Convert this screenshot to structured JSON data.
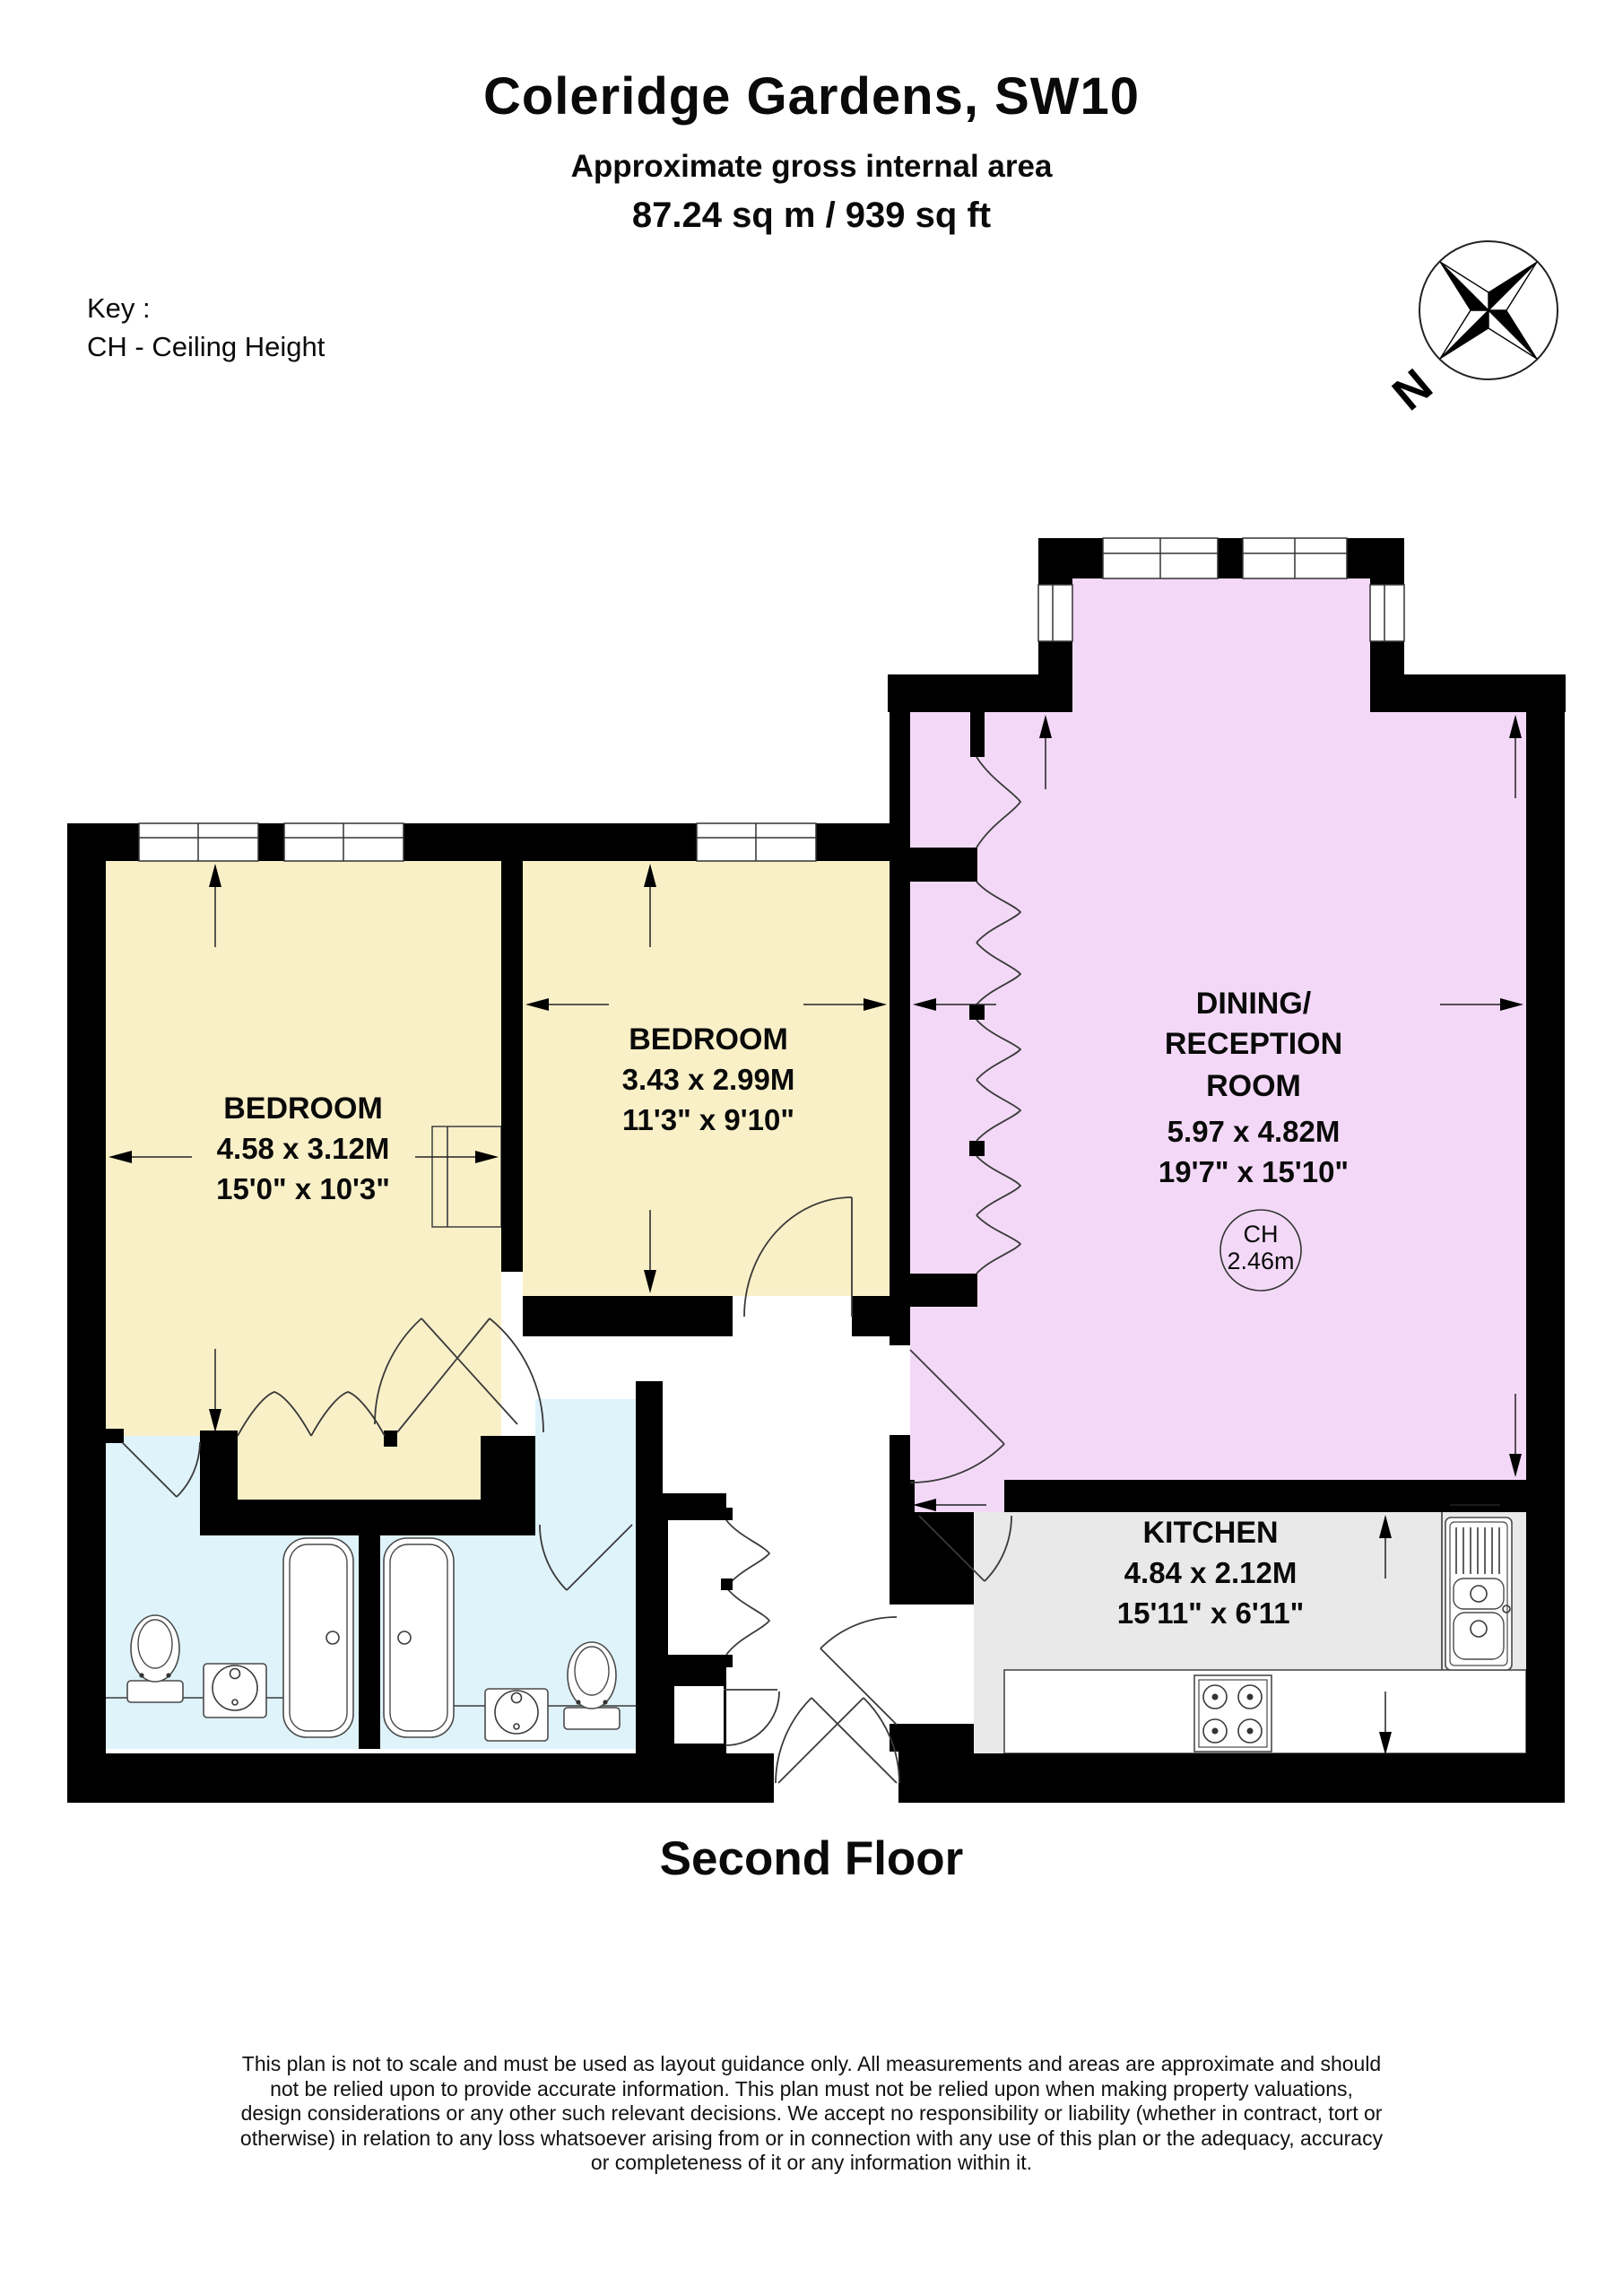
{
  "header": {
    "title": "Coleridge Gardens, SW10",
    "subtitle": "Approximate gross internal area",
    "area": "87.24 sq m /  939 sq ft"
  },
  "key": {
    "heading": "Key :",
    "line": "CH - Ceiling Height"
  },
  "compass": {
    "label": "N"
  },
  "rooms": [
    {
      "name": "BEDROOM",
      "metric": "4.58 x 3.12M",
      "imperial": "15'0\" x 10'3\""
    },
    {
      "name": "BEDROOM",
      "metric": "3.43 x 2.99M",
      "imperial": "11'3\" x 9'10\""
    },
    {
      "name_lines": [
        "DINING/",
        "RECEPTION",
        "ROOM"
      ],
      "metric": "5.97 x 4.82M",
      "imperial": "19'7\" x 15'10\"",
      "ceiling": {
        "label": "CH",
        "value": "2.46m"
      }
    },
    {
      "name": "KITCHEN",
      "metric": "4.84 x 2.12M",
      "imperial": "15'11\" x 6'11\""
    }
  ],
  "floor_label": "Second Floor",
  "disclaimer_lines": [
    "This plan is not to scale and must be used as layout guidance only. All measurements and areas are approximate and should",
    "not be relied upon to provide accurate information. This plan must not be relied upon when making property valuations,",
    "design considerations or any other such relevant decisions. We accept no responsibility or liability (whether in contract, tort or",
    "otherwise) in relation to any loss whatsoever arising from or in connection with any use of this plan or the adequacy, accuracy",
    "or completeness of it or any information within it."
  ],
  "colors": {
    "bedroom": "#FAF0C8",
    "dining": "#F3D9F7",
    "bathroom": "#DFF3FB",
    "kitchen": "#E9E9E9",
    "wall": "#000000"
  }
}
